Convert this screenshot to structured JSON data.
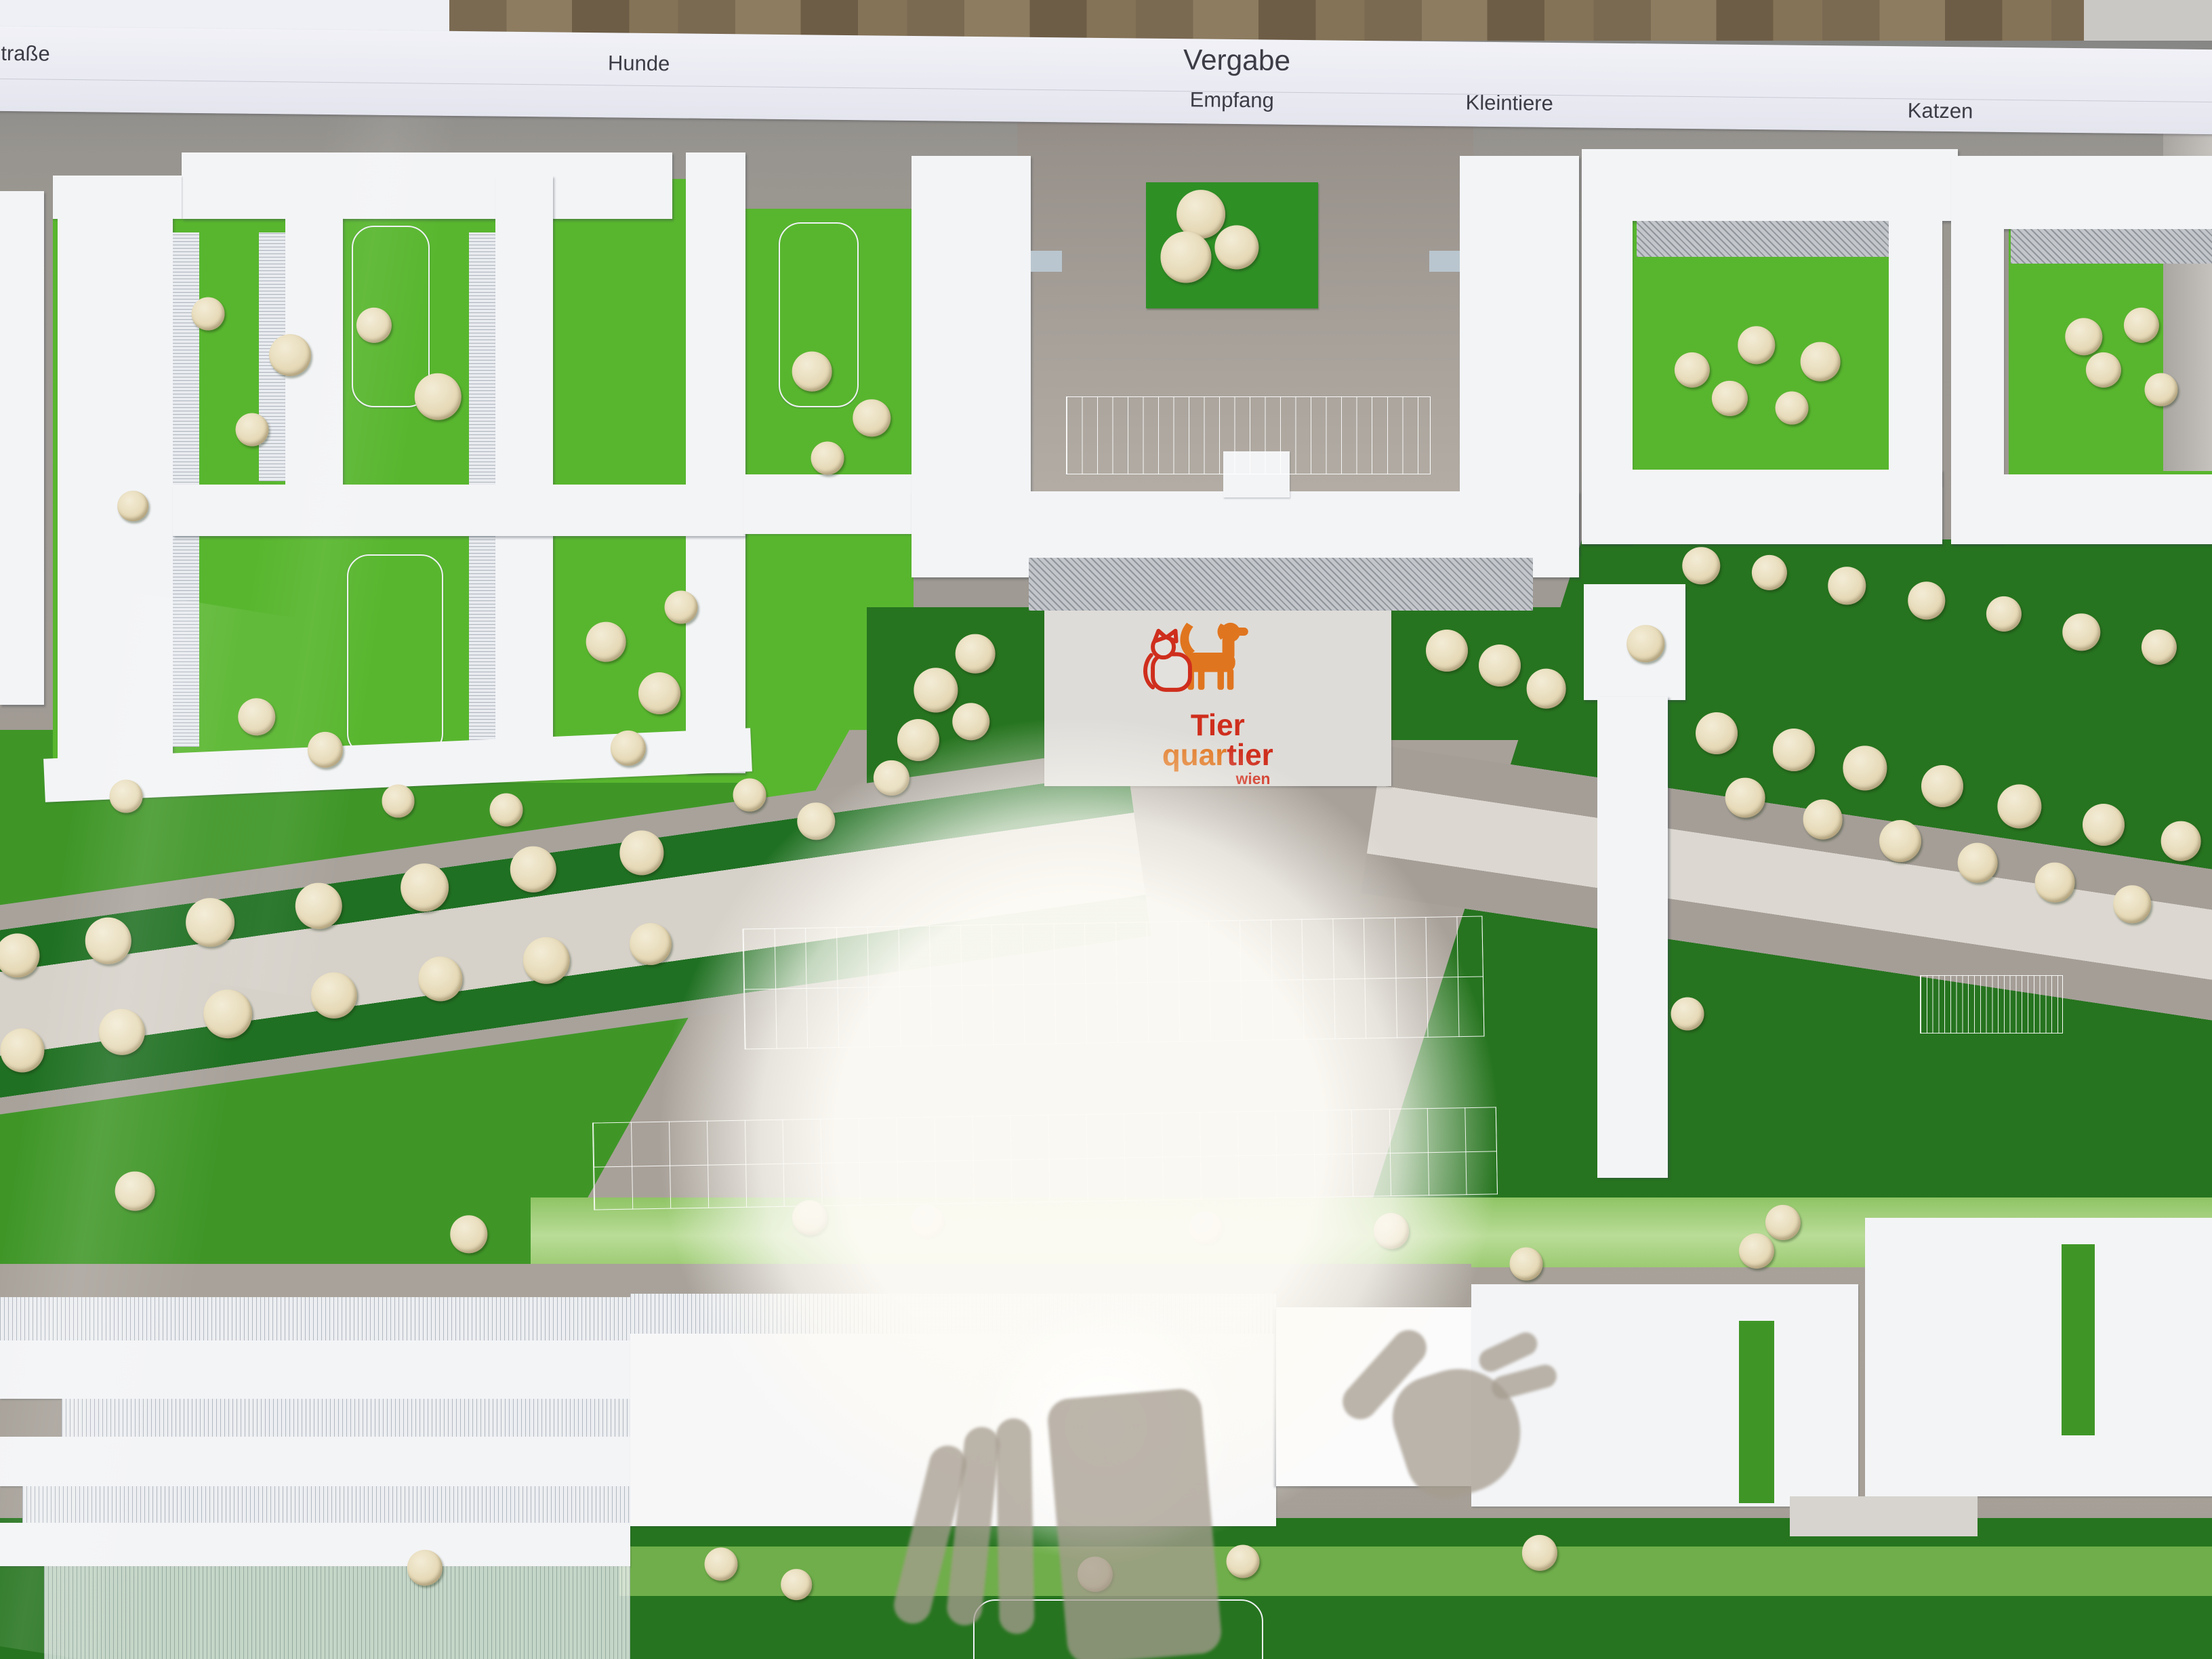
{
  "header": {
    "strasse": "Straße",
    "hunde": "Hunde",
    "vergabe": "Vergabe",
    "empfang": "Empfang",
    "kleintiere": "Kleintiere",
    "katzen": "Katzen"
  },
  "logo": {
    "tier": "Tier",
    "quar": "quar",
    "tier2": "tier",
    "wien": "wien"
  },
  "colors": {
    "logo_red": "#cf2e1d",
    "logo_orange": "#e0751f",
    "lawn_bright": "#58b62e",
    "lawn_mid": "#3f9627",
    "lawn_dark": "#26741f",
    "lawn_pale": "#9ccb72",
    "base_gray": "#a19b94",
    "road_light": "#d6d1c9",
    "building_white": "#f3f4f6",
    "tree_cream": "#e6dab8",
    "wood_brown": "#7b6a52"
  },
  "model": {
    "trees": [
      {
        "x": 9.4,
        "y": 18.9,
        "d": 1.5
      },
      {
        "x": 13.1,
        "y": 21.4,
        "d": 1.9
      },
      {
        "x": 16.9,
        "y": 19.6,
        "d": 1.6
      },
      {
        "x": 19.8,
        "y": 23.9,
        "d": 2.1
      },
      {
        "x": 11.4,
        "y": 25.9,
        "d": 1.5
      },
      {
        "x": 6.0,
        "y": 30.5,
        "d": 1.4
      },
      {
        "x": 11.6,
        "y": 43.2,
        "d": 1.7
      },
      {
        "x": 14.7,
        "y": 45.2,
        "d": 1.6
      },
      {
        "x": 18.0,
        "y": 48.3,
        "d": 1.5
      },
      {
        "x": 27.4,
        "y": 38.7,
        "d": 1.8
      },
      {
        "x": 29.8,
        "y": 41.8,
        "d": 1.9
      },
      {
        "x": 30.8,
        "y": 36.6,
        "d": 1.5
      },
      {
        "x": 28.4,
        "y": 45.1,
        "d": 1.6
      },
      {
        "x": 22.9,
        "y": 48.8,
        "d": 1.5
      },
      {
        "x": 36.7,
        "y": 22.4,
        "d": 1.8
      },
      {
        "x": 39.4,
        "y": 25.2,
        "d": 1.7
      },
      {
        "x": 37.4,
        "y": 27.6,
        "d": 1.5
      },
      {
        "x": 54.3,
        "y": 12.9,
        "d": 2.2
      },
      {
        "x": 55.9,
        "y": 14.9,
        "d": 2.0
      },
      {
        "x": 53.6,
        "y": 15.5,
        "d": 2.3
      },
      {
        "x": 42.3,
        "y": 41.6,
        "d": 2.0
      },
      {
        "x": 44.1,
        "y": 39.4,
        "d": 1.8
      },
      {
        "x": 41.5,
        "y": 44.6,
        "d": 1.9
      },
      {
        "x": 43.9,
        "y": 43.5,
        "d": 1.7
      },
      {
        "x": 40.3,
        "y": 46.9,
        "d": 1.6
      },
      {
        "x": 36.9,
        "y": 49.5,
        "d": 1.7
      },
      {
        "x": 33.9,
        "y": 47.9,
        "d": 1.5
      },
      {
        "x": 65.4,
        "y": 39.2,
        "d": 1.9
      },
      {
        "x": 67.8,
        "y": 40.1,
        "d": 1.9
      },
      {
        "x": 69.9,
        "y": 41.5,
        "d": 1.8
      },
      {
        "x": 74.4,
        "y": 38.8,
        "d": 1.7
      },
      {
        "x": 77.6,
        "y": 44.2,
        "d": 1.9
      },
      {
        "x": 81.1,
        "y": 45.2,
        "d": 1.9
      },
      {
        "x": 84.3,
        "y": 46.3,
        "d": 2.0
      },
      {
        "x": 87.8,
        "y": 47.4,
        "d": 1.9
      },
      {
        "x": 91.3,
        "y": 48.6,
        "d": 2.0
      },
      {
        "x": 95.1,
        "y": 49.7,
        "d": 1.9
      },
      {
        "x": 98.6,
        "y": 50.7,
        "d": 1.8
      },
      {
        "x": 78.9,
        "y": 48.1,
        "d": 1.8
      },
      {
        "x": 82.4,
        "y": 49.4,
        "d": 1.8
      },
      {
        "x": 85.9,
        "y": 50.7,
        "d": 1.9
      },
      {
        "x": 89.4,
        "y": 52.0,
        "d": 1.8
      },
      {
        "x": 92.9,
        "y": 53.2,
        "d": 1.8
      },
      {
        "x": 96.4,
        "y": 54.5,
        "d": 1.7
      },
      {
        "x": 76.3,
        "y": 61.1,
        "d": 1.5
      },
      {
        "x": 80.6,
        "y": 73.7,
        "d": 1.6
      },
      {
        "x": 76.5,
        "y": 22.3,
        "d": 1.6
      },
      {
        "x": 79.4,
        "y": 20.8,
        "d": 1.7
      },
      {
        "x": 82.3,
        "y": 21.8,
        "d": 1.8
      },
      {
        "x": 78.2,
        "y": 24.0,
        "d": 1.6
      },
      {
        "x": 81.0,
        "y": 24.6,
        "d": 1.5
      },
      {
        "x": 94.2,
        "y": 20.3,
        "d": 1.7
      },
      {
        "x": 96.8,
        "y": 19.6,
        "d": 1.6
      },
      {
        "x": 95.1,
        "y": 22.3,
        "d": 1.6
      },
      {
        "x": 97.7,
        "y": 23.5,
        "d": 1.5
      },
      {
        "x": 76.9,
        "y": 34.1,
        "d": 1.7
      },
      {
        "x": 80.0,
        "y": 34.5,
        "d": 1.6
      },
      {
        "x": 83.5,
        "y": 35.3,
        "d": 1.7
      },
      {
        "x": 87.1,
        "y": 36.2,
        "d": 1.7
      },
      {
        "x": 90.6,
        "y": 37.0,
        "d": 1.6
      },
      {
        "x": 94.1,
        "y": 38.1,
        "d": 1.7
      },
      {
        "x": 97.6,
        "y": 39.0,
        "d": 1.6
      },
      {
        "x": 0.8,
        "y": 57.6,
        "d": 2.0
      },
      {
        "x": 4.9,
        "y": 56.7,
        "d": 2.1
      },
      {
        "x": 9.5,
        "y": 55.6,
        "d": 2.2
      },
      {
        "x": 14.4,
        "y": 54.6,
        "d": 2.1
      },
      {
        "x": 19.2,
        "y": 53.5,
        "d": 2.2
      },
      {
        "x": 24.1,
        "y": 52.4,
        "d": 2.1
      },
      {
        "x": 29.0,
        "y": 51.4,
        "d": 2.0
      },
      {
        "x": 1.0,
        "y": 63.3,
        "d": 2.0
      },
      {
        "x": 5.5,
        "y": 62.2,
        "d": 2.1
      },
      {
        "x": 10.3,
        "y": 61.1,
        "d": 2.2
      },
      {
        "x": 15.1,
        "y": 60.0,
        "d": 2.1
      },
      {
        "x": 19.9,
        "y": 59.0,
        "d": 2.0
      },
      {
        "x": 24.7,
        "y": 57.9,
        "d": 2.1
      },
      {
        "x": 29.4,
        "y": 56.9,
        "d": 1.9
      },
      {
        "x": 6.1,
        "y": 71.8,
        "d": 1.8
      },
      {
        "x": 21.2,
        "y": 74.4,
        "d": 1.7
      },
      {
        "x": 5.7,
        "y": 48.0,
        "d": 1.5
      },
      {
        "x": 36.6,
        "y": 73.4,
        "d": 1.6
      },
      {
        "x": 41.9,
        "y": 73.6,
        "d": 1.5
      },
      {
        "x": 54.5,
        "y": 74.0,
        "d": 1.5
      },
      {
        "x": 62.9,
        "y": 74.2,
        "d": 1.6
      },
      {
        "x": 69.0,
        "y": 76.2,
        "d": 1.5
      },
      {
        "x": 79.4,
        "y": 75.4,
        "d": 1.6
      },
      {
        "x": 19.2,
        "y": 94.5,
        "d": 1.6
      },
      {
        "x": 32.6,
        "y": 94.3,
        "d": 1.5
      },
      {
        "x": 49.5,
        "y": 94.9,
        "d": 1.6
      },
      {
        "x": 56.2,
        "y": 94.1,
        "d": 1.5
      },
      {
        "x": 69.6,
        "y": 93.6,
        "d": 1.6
      },
      {
        "x": 36.0,
        "y": 95.5,
        "d": 1.4
      }
    ]
  }
}
